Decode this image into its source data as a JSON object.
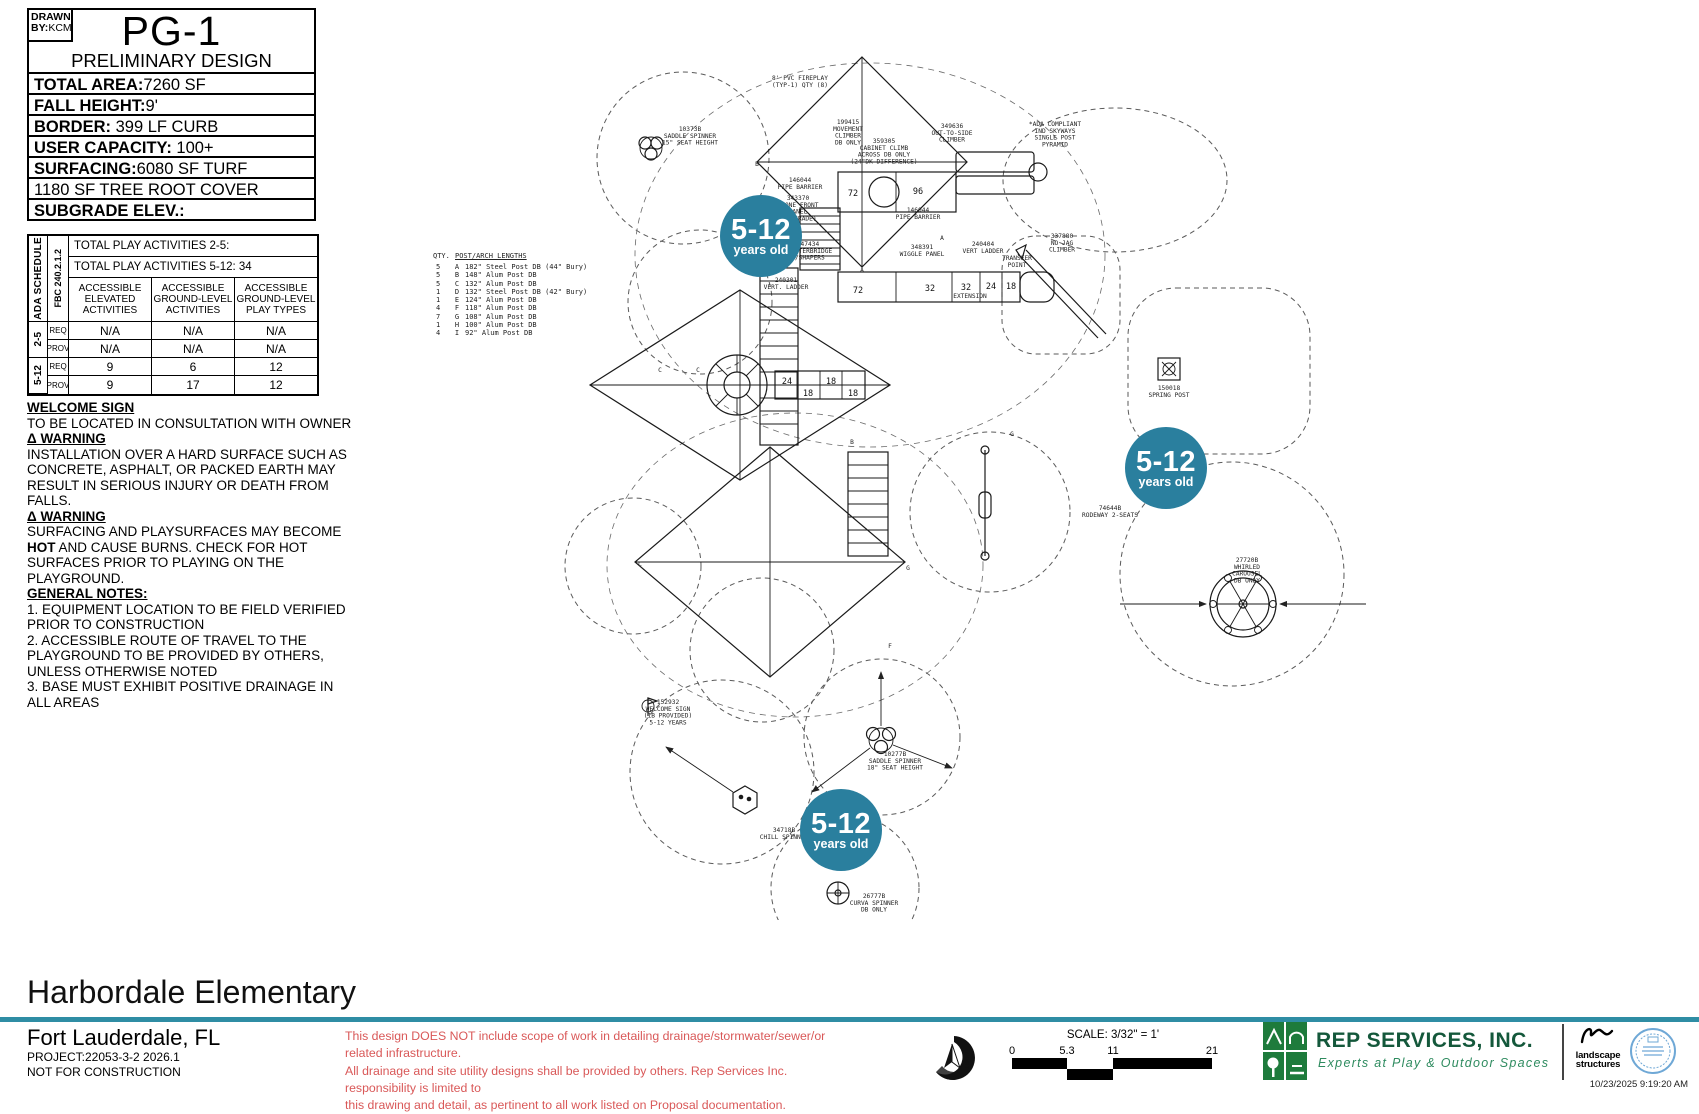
{
  "title_block": {
    "drawn_l1": "DRAWN",
    "drawn_l2": "BY:",
    "drawn_by": "KCM",
    "sheet": "PG-1",
    "subtitle": "PRELIMINARY DESIGN",
    "specs": [
      {
        "label": "TOTAL AREA:",
        "value": "7260 SF"
      },
      {
        "label": "FALL HEIGHT:",
        "value": "9'"
      },
      {
        "label": "BORDER: ",
        "value": "399 LF CURB"
      },
      {
        "label": "USER CAPACITY: ",
        "value": "100+"
      },
      {
        "label": "SURFACING:",
        "value": "6080 SF TURF"
      },
      {
        "label": "",
        "value": "1180 SF TREE ROOT COVER"
      },
      {
        "label": "SUBGRADE ELEV.:",
        "value": ""
      }
    ]
  },
  "ada_schedule": {
    "side_label": "ADA SCHEDULE",
    "code_label": "FBC 240.2.1.2",
    "totals": [
      "TOTAL PLAY ACTIVITIES 2-5:",
      "TOTAL PLAY ACTIVITIES 5-12: 34"
    ],
    "headers": [
      "ACCESSIBLE ELEVATED ACTIVITIES",
      "ACCESSIBLE GROUND-LEVEL ACTIVITIES",
      "ACCESSIBLE GROUND-LEVEL PLAY TYPES"
    ],
    "ages": [
      "2-5",
      "5-12"
    ],
    "rows": [
      {
        "label": "REQ",
        "values": [
          "N/A",
          "N/A",
          "N/A"
        ]
      },
      {
        "label": "PROV",
        "values": [
          "N/A",
          "N/A",
          "N/A"
        ]
      },
      {
        "label": "REQ",
        "values": [
          "9",
          "6",
          "12"
        ]
      },
      {
        "label": "PROV",
        "values": [
          "9",
          "17",
          "12"
        ]
      }
    ]
  },
  "notes": {
    "welcome_title": "WELCOME SIGN",
    "welcome_body": "TO BE LOCATED IN CONSULTATION WITH OWNER",
    "warning_title": "Δ WARNING",
    "warning1_body": "INSTALLATION OVER A HARD SURFACE SUCH AS CONCRETE, ASPHALT, OR PACKED EARTH MAY RESULT IN SERIOUS INJURY OR DEATH FROM FALLS.",
    "warning2_pre": "SURFACING AND PLAYSURFACES MAY BECOME ",
    "warning2_hot": "HOT",
    "warning2_post": " AND CAUSE BURNS.  CHECK FOR HOT SURFACES PRIOR TO PLAYING ON THE PLAYGROUND.",
    "general_title": "GENERAL NOTES:",
    "general_items": [
      "1.  EQUIPMENT LOCATION TO BE FIELD VERIFIED PRIOR TO CONSTRUCTION",
      "2.  ACCESSIBLE ROUTE OF TRAVEL TO THE PLAYGROUND TO BE PROVIDED BY OTHERS, UNLESS OTHERWISE NOTED",
      "3.  BASE MUST EXHIBIT POSITIVE DRAINAGE IN ALL AREAS"
    ]
  },
  "plan": {
    "badge": {
      "top": "5-12",
      "bottom": "years old"
    },
    "badge_color": "#2a7f9e",
    "legend": {
      "qty_label": "QTY.",
      "title": "POST/ARCH LENGTHS",
      "rows": [
        [
          "5",
          "A",
          "182\" Steel Post DB (44\" Bury)"
        ],
        [
          "5",
          "B",
          "148\" Alum Post DB"
        ],
        [
          "5",
          "C",
          "132\" Alum Post DB"
        ],
        [
          "1",
          "D",
          "132\" Steel Post DB (42\" Bury)"
        ],
        [
          "1",
          "E",
          "124\" Alum Post DB"
        ],
        [
          "4",
          "F",
          "118\" Alum Post DB"
        ],
        [
          "7",
          "G",
          "108\" Alum Post DB"
        ],
        [
          "1",
          "H",
          "100\" Alum Post DB"
        ],
        [
          "4",
          "I",
          "92\" Alum Post DB"
        ]
      ]
    },
    "labels": [
      {
        "x": 690,
        "y": 131,
        "lines": [
          "10373B",
          "SADDLE SPINNER",
          "15\" SEAT HEIGHT"
        ]
      },
      {
        "x": 800,
        "y": 80,
        "lines": [
          "8' PVC FIREPLAY",
          "(TYP-1) QTY (8)"
        ]
      },
      {
        "x": 848,
        "y": 124,
        "lines": [
          "199415",
          "MOVEMENT",
          "CLIMBER",
          "DB ONLY"
        ]
      },
      {
        "x": 884,
        "y": 143,
        "lines": [
          "359305",
          "CABINET CLIMB",
          "ACROSS DB ONLY",
          "(24\"DK DIFFERENCE)"
        ]
      },
      {
        "x": 952,
        "y": 128,
        "lines": [
          "349636",
          "OUT-TO-SIDE",
          "CLIMBER"
        ]
      },
      {
        "x": 1055,
        "y": 126,
        "lines": [
          "*ADA COMPLIANT",
          "IND SKYWAYS",
          "SINGLE POST",
          "PYRAMID"
        ]
      },
      {
        "x": 800,
        "y": 182,
        "lines": [
          "146044",
          "PIPE BARRIER"
        ]
      },
      {
        "x": 798,
        "y": 200,
        "lines": [
          "343370",
          "STONE FRONT",
          "PANEL",
          "(AT GRADE)"
        ]
      },
      {
        "x": 918,
        "y": 212,
        "lines": [
          "146044",
          "PIPE BARRIER"
        ]
      },
      {
        "x": 808,
        "y": 246,
        "lines": [
          "147434",
          "CLATTERBRIDGE",
          "W/SHAPERS"
        ]
      },
      {
        "x": 786,
        "y": 282,
        "lines": [
          "240301",
          "VERT. LADDER"
        ]
      },
      {
        "x": 922,
        "y": 249,
        "lines": [
          "348391",
          "WIGGLE PANEL"
        ]
      },
      {
        "x": 983,
        "y": 246,
        "lines": [
          "240404",
          "VERT LADDER"
        ]
      },
      {
        "x": 1017,
        "y": 260,
        "lines": [
          "TRANSFER",
          "POINT"
        ]
      },
      {
        "x": 970,
        "y": 298,
        "lines": [
          "EXTENSION"
        ]
      },
      {
        "x": 1062,
        "y": 238,
        "lines": [
          "337880",
          "NO JAG",
          "CLIMBER"
        ]
      },
      {
        "x": 1169,
        "y": 390,
        "lines": [
          "150018",
          "SPRING POST"
        ]
      },
      {
        "x": 1110,
        "y": 510,
        "lines": [
          "74644B",
          "RODEWAY 2-SEATS"
        ]
      },
      {
        "x": 1247,
        "y": 562,
        "lines": [
          "27720B",
          "WHIRLED",
          "CAROUSEL",
          "DB ONLY"
        ]
      },
      {
        "x": 895,
        "y": 756,
        "lines": [
          "10277B",
          "SADDLE SPINNER",
          "18\" SEAT HEIGHT"
        ]
      },
      {
        "x": 784,
        "y": 832,
        "lines": [
          "34718B",
          "CHILL SPINNER"
        ]
      },
      {
        "x": 874,
        "y": 898,
        "lines": [
          "26777B",
          "CURVA SPINNER",
          "DB ONLY"
        ]
      },
      {
        "x": 668,
        "y": 704,
        "lines": [
          "152932",
          "WELCOME SIGN",
          "(1B PROVIDED)",
          "5-12 YEARS"
        ]
      },
      {
        "x": 757,
        "y": 166,
        "lines": [
          "B"
        ]
      },
      {
        "x": 942,
        "y": 240,
        "lines": [
          "A"
        ]
      },
      {
        "x": 862,
        "y": 272,
        "lines": [
          "A"
        ]
      },
      {
        "x": 660,
        "y": 372,
        "lines": [
          "C"
        ]
      },
      {
        "x": 698,
        "y": 372,
        "lines": [
          "C"
        ]
      },
      {
        "x": 852,
        "y": 444,
        "lines": [
          "B"
        ]
      },
      {
        "x": 890,
        "y": 648,
        "lines": [
          "F"
        ]
      },
      {
        "x": 1012,
        "y": 436,
        "lines": [
          "G"
        ]
      },
      {
        "x": 908,
        "y": 570,
        "lines": [
          "G"
        ]
      },
      {
        "x": 640,
        "y": 566,
        "lines": [
          "C"
        ]
      }
    ],
    "deck_numbers": [
      {
        "x": 853,
        "y": 196,
        "t": "72"
      },
      {
        "x": 918,
        "y": 194,
        "t": "96"
      },
      {
        "x": 858,
        "y": 293,
        "t": "72"
      },
      {
        "x": 930,
        "y": 291,
        "t": "32"
      },
      {
        "x": 966,
        "y": 290,
        "t": "32"
      },
      {
        "x": 991,
        "y": 289,
        "t": "24"
      },
      {
        "x": 1011,
        "y": 289,
        "t": "18"
      },
      {
        "x": 787,
        "y": 384,
        "t": "24"
      },
      {
        "x": 808,
        "y": 396,
        "t": "18"
      },
      {
        "x": 831,
        "y": 384,
        "t": "18"
      },
      {
        "x": 853,
        "y": 396,
        "t": "18"
      }
    ]
  },
  "footer": {
    "project_title": "Harbordale Elementary",
    "location": "Fort Lauderdale, FL",
    "project_no": "PROJECT:22053-3-2 2026.1",
    "status": "NOT FOR CONSTRUCTION",
    "disclaimer": [
      "This design DOES NOT include scope of work in detailing drainage/stormwater/sewer/or related infrastructure.",
      "All drainage and site utility designs shall be provided by others. Rep Services Inc. responsibility is limited to",
      "this drawing and detail, as pertinent to all work listed on Proposal documentation."
    ],
    "north_label": "NORTH",
    "scale_label": "SCALE: 3/32\" = 1'",
    "scale_ticks": [
      "0",
      "5.3",
      "11",
      "21"
    ],
    "company": "REP SERVICES, INC.",
    "tagline": "Experts at Play & Outdoor Spaces",
    "ls_line1": "landscape",
    "ls_line2": "structures",
    "timestamp": "10/23/2025 9:19:20 AM",
    "colors": {
      "divider": "#2f8da4",
      "disclaimer_red": "#d95858",
      "logo_green": "#1e7b3c",
      "company_green": "#14583b",
      "tagline_green": "#2e8b5f",
      "stamp_blue": "#6fa8d6"
    }
  }
}
